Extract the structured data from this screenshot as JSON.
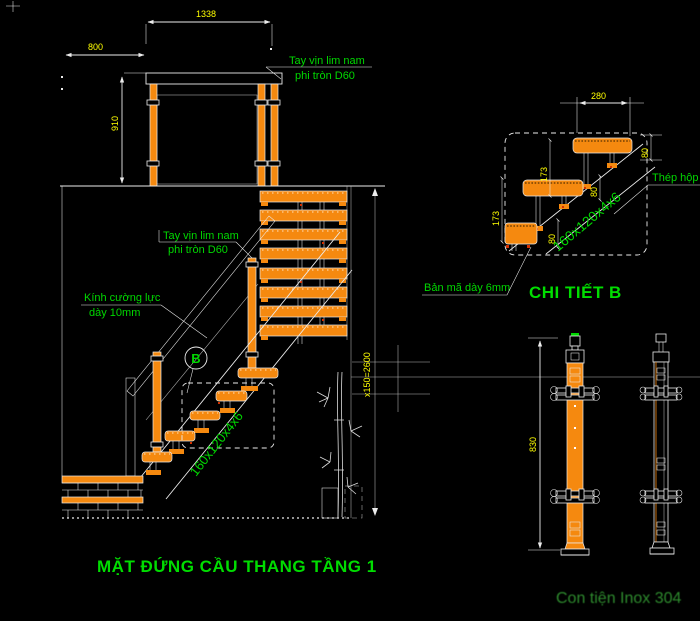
{
  "colors": {
    "background": "#000000",
    "line": "#ececec",
    "orange": "#f5890f",
    "dim_text": "#ffff00",
    "label_green": "#00d800",
    "title_green": "#00dd00",
    "caption_green": "#2e8b2e",
    "red": "#d43000"
  },
  "elevation": {
    "title": "MẶT ĐỨNG CẦU THANG TẦNG 1",
    "dim_width": "1338",
    "dim_offset": "800",
    "dim_rail_height": "910",
    "dim_total_rise": "x150=2600",
    "handrail_label_line1": "Tay vịn lim nam",
    "handrail_label_line2": "phi tròn D60",
    "handrail_label2_line1": "Tay vịn lim nam",
    "handrail_label2_line2": "phi tròn D60",
    "glass_label_line1": "Kính cường lực",
    "glass_label_line2": "dày 10mm",
    "stringer_label": "160x120x4x6",
    "detail_marker": "B"
  },
  "detail_b": {
    "title": "CHI TIẾT B",
    "dim_tread_width": "280",
    "dim_rise_a": "173",
    "dim_rise_b": "173",
    "dim_thk_a": "80",
    "dim_thk_b": "80",
    "dim_thk_right": "80",
    "plate_label": "Bản mã dày 6mm",
    "box_steel_label": "Thép hộp",
    "stringer_label": "160x120x4x6"
  },
  "balusters": {
    "caption": "Con tiện Inox 304",
    "dim_height": "830"
  }
}
